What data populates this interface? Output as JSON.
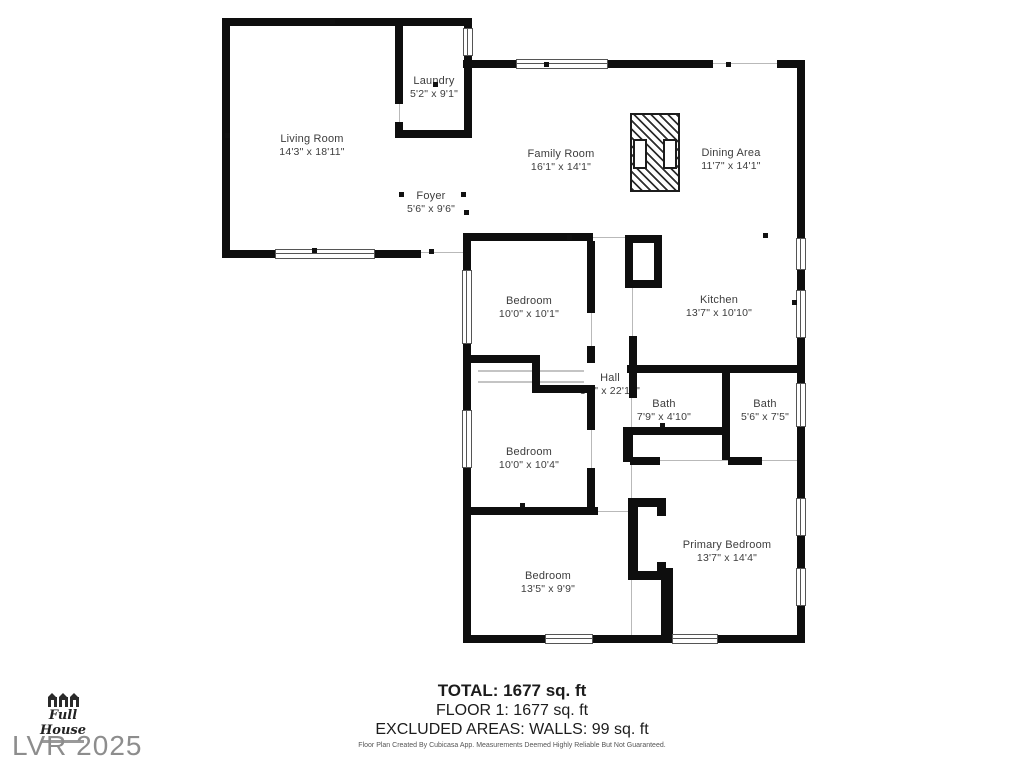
{
  "rooms": [
    {
      "name": "Living Room",
      "dims": "14'3\" x 18'11\""
    },
    {
      "name": "Laundry",
      "dims": "5'2\" x 9'1\""
    },
    {
      "name": "Family Room",
      "dims": "16'1\" x 14'1\""
    },
    {
      "name": "Dining Area",
      "dims": "11'7\" x 14'1\""
    },
    {
      "name": "Foyer",
      "dims": "5'6\" x 9'6\""
    },
    {
      "name": "Bedroom",
      "dims": "10'0\" x 10'1\""
    },
    {
      "name": "Kitchen",
      "dims": "13'7\" x 10'10\""
    },
    {
      "name": "Hall",
      "dims": "3'1\" x 22'10\""
    },
    {
      "name": "Bath",
      "dims": "7'9\" x 4'10\""
    },
    {
      "name": "Bath",
      "dims": "5'6\" x 7'5\""
    },
    {
      "name": "Bedroom",
      "dims": "10'0\" x 10'4\""
    },
    {
      "name": "Primary Bedroom",
      "dims": "13'7\" x 14'4\""
    },
    {
      "name": "Bedroom",
      "dims": "13'5\" x 9'9\""
    }
  ],
  "summary": {
    "total": "TOTAL: 1677 sq. ft",
    "floor": "FLOOR 1: 1677 sq. ft",
    "excluded": "EXCLUDED AREAS: WALLS: 99 sq. ft"
  },
  "footer": {
    "disclaimer": "Floor Plan Created By Cubicasa App. Measurements Deemed Highly Reliable But Not Guaranteed."
  },
  "branding": {
    "logo_text": "Full House",
    "watermark": "LVR 2025"
  },
  "colors": {
    "wall": "#0e0e0e",
    "label": "#3d3d3d",
    "watermark": "#8d8d8d"
  }
}
